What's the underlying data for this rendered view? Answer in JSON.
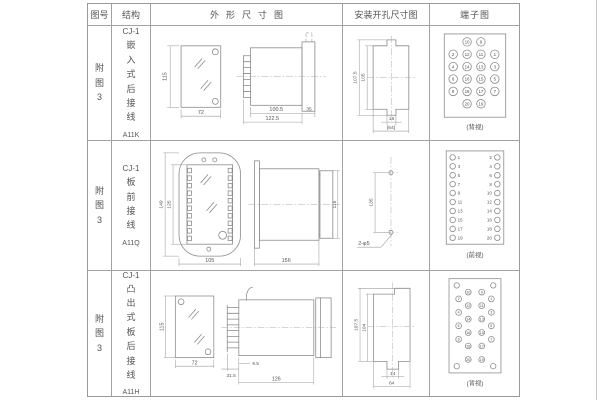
{
  "header": {
    "fig": "图号",
    "struct": "结构",
    "outline": "外形尺寸图",
    "mount": "安装开孔尺寸图",
    "terminal": "端子图"
  },
  "rows": [
    {
      "fig": "附图3",
      "model": "CJ-1",
      "struct_text": "嵌入式后接线",
      "code": "A11K",
      "outline": {
        "height": "115",
        "width": "72",
        "len": "100.5",
        "total": "122.5",
        "depth": "35"
      },
      "mount": {
        "outer": "107.5",
        "inner": "105",
        "slot": "16",
        "width": "[64]"
      },
      "terminal": {
        "caption": "(背视)",
        "grid": [
          [
            "10",
            "9"
          ],
          [
            "2",
            "12",
            "11",
            "1"
          ],
          [
            "4",
            "14",
            "13",
            "3"
          ],
          [
            "6",
            "16",
            "15",
            "5"
          ],
          [
            "8",
            "18",
            "17",
            "7"
          ],
          [
            "20",
            "19"
          ]
        ]
      }
    },
    {
      "fig": "附图3",
      "model": "CJ-1",
      "struct_text": "板前接线",
      "code": "A11Q",
      "outline": {
        "outer_h": "149",
        "inner_h": "125",
        "width": "105",
        "len": "156",
        "side_h": "115"
      },
      "mount": {
        "spacing": "135",
        "holes": "2-φ5"
      },
      "terminal": {
        "caption": "(前视)",
        "left": [
          "1",
          "3",
          "5",
          "7",
          "9",
          "11",
          "13",
          "15",
          "17",
          "19"
        ],
        "right": [
          "2",
          "4",
          "6",
          "8",
          "10",
          "12",
          "14",
          "16",
          "18",
          "20"
        ]
      }
    },
    {
      "fig": "附图3",
      "model": "CJ-1",
      "struct_text": "凸出式板后接线",
      "code": "A11H",
      "outline": {
        "height": "115",
        "width": "72",
        "fin": "31.5",
        "gap": "9.5",
        "len": "126"
      },
      "mount": {
        "outer": "107.5",
        "inner": "104",
        "slot": "14",
        "width": "64"
      },
      "terminal": {
        "caption": "(背视)",
        "left_outer": [
          "2",
          "4",
          "6",
          "8"
        ],
        "left_inner": [
          "10",
          "12",
          "14",
          "16",
          "18",
          "20"
        ],
        "right_inner": [
          "9",
          "11",
          "13",
          "15",
          "17",
          "19"
        ],
        "right_outer": [
          "1",
          "3",
          "5",
          "7"
        ]
      }
    }
  ]
}
